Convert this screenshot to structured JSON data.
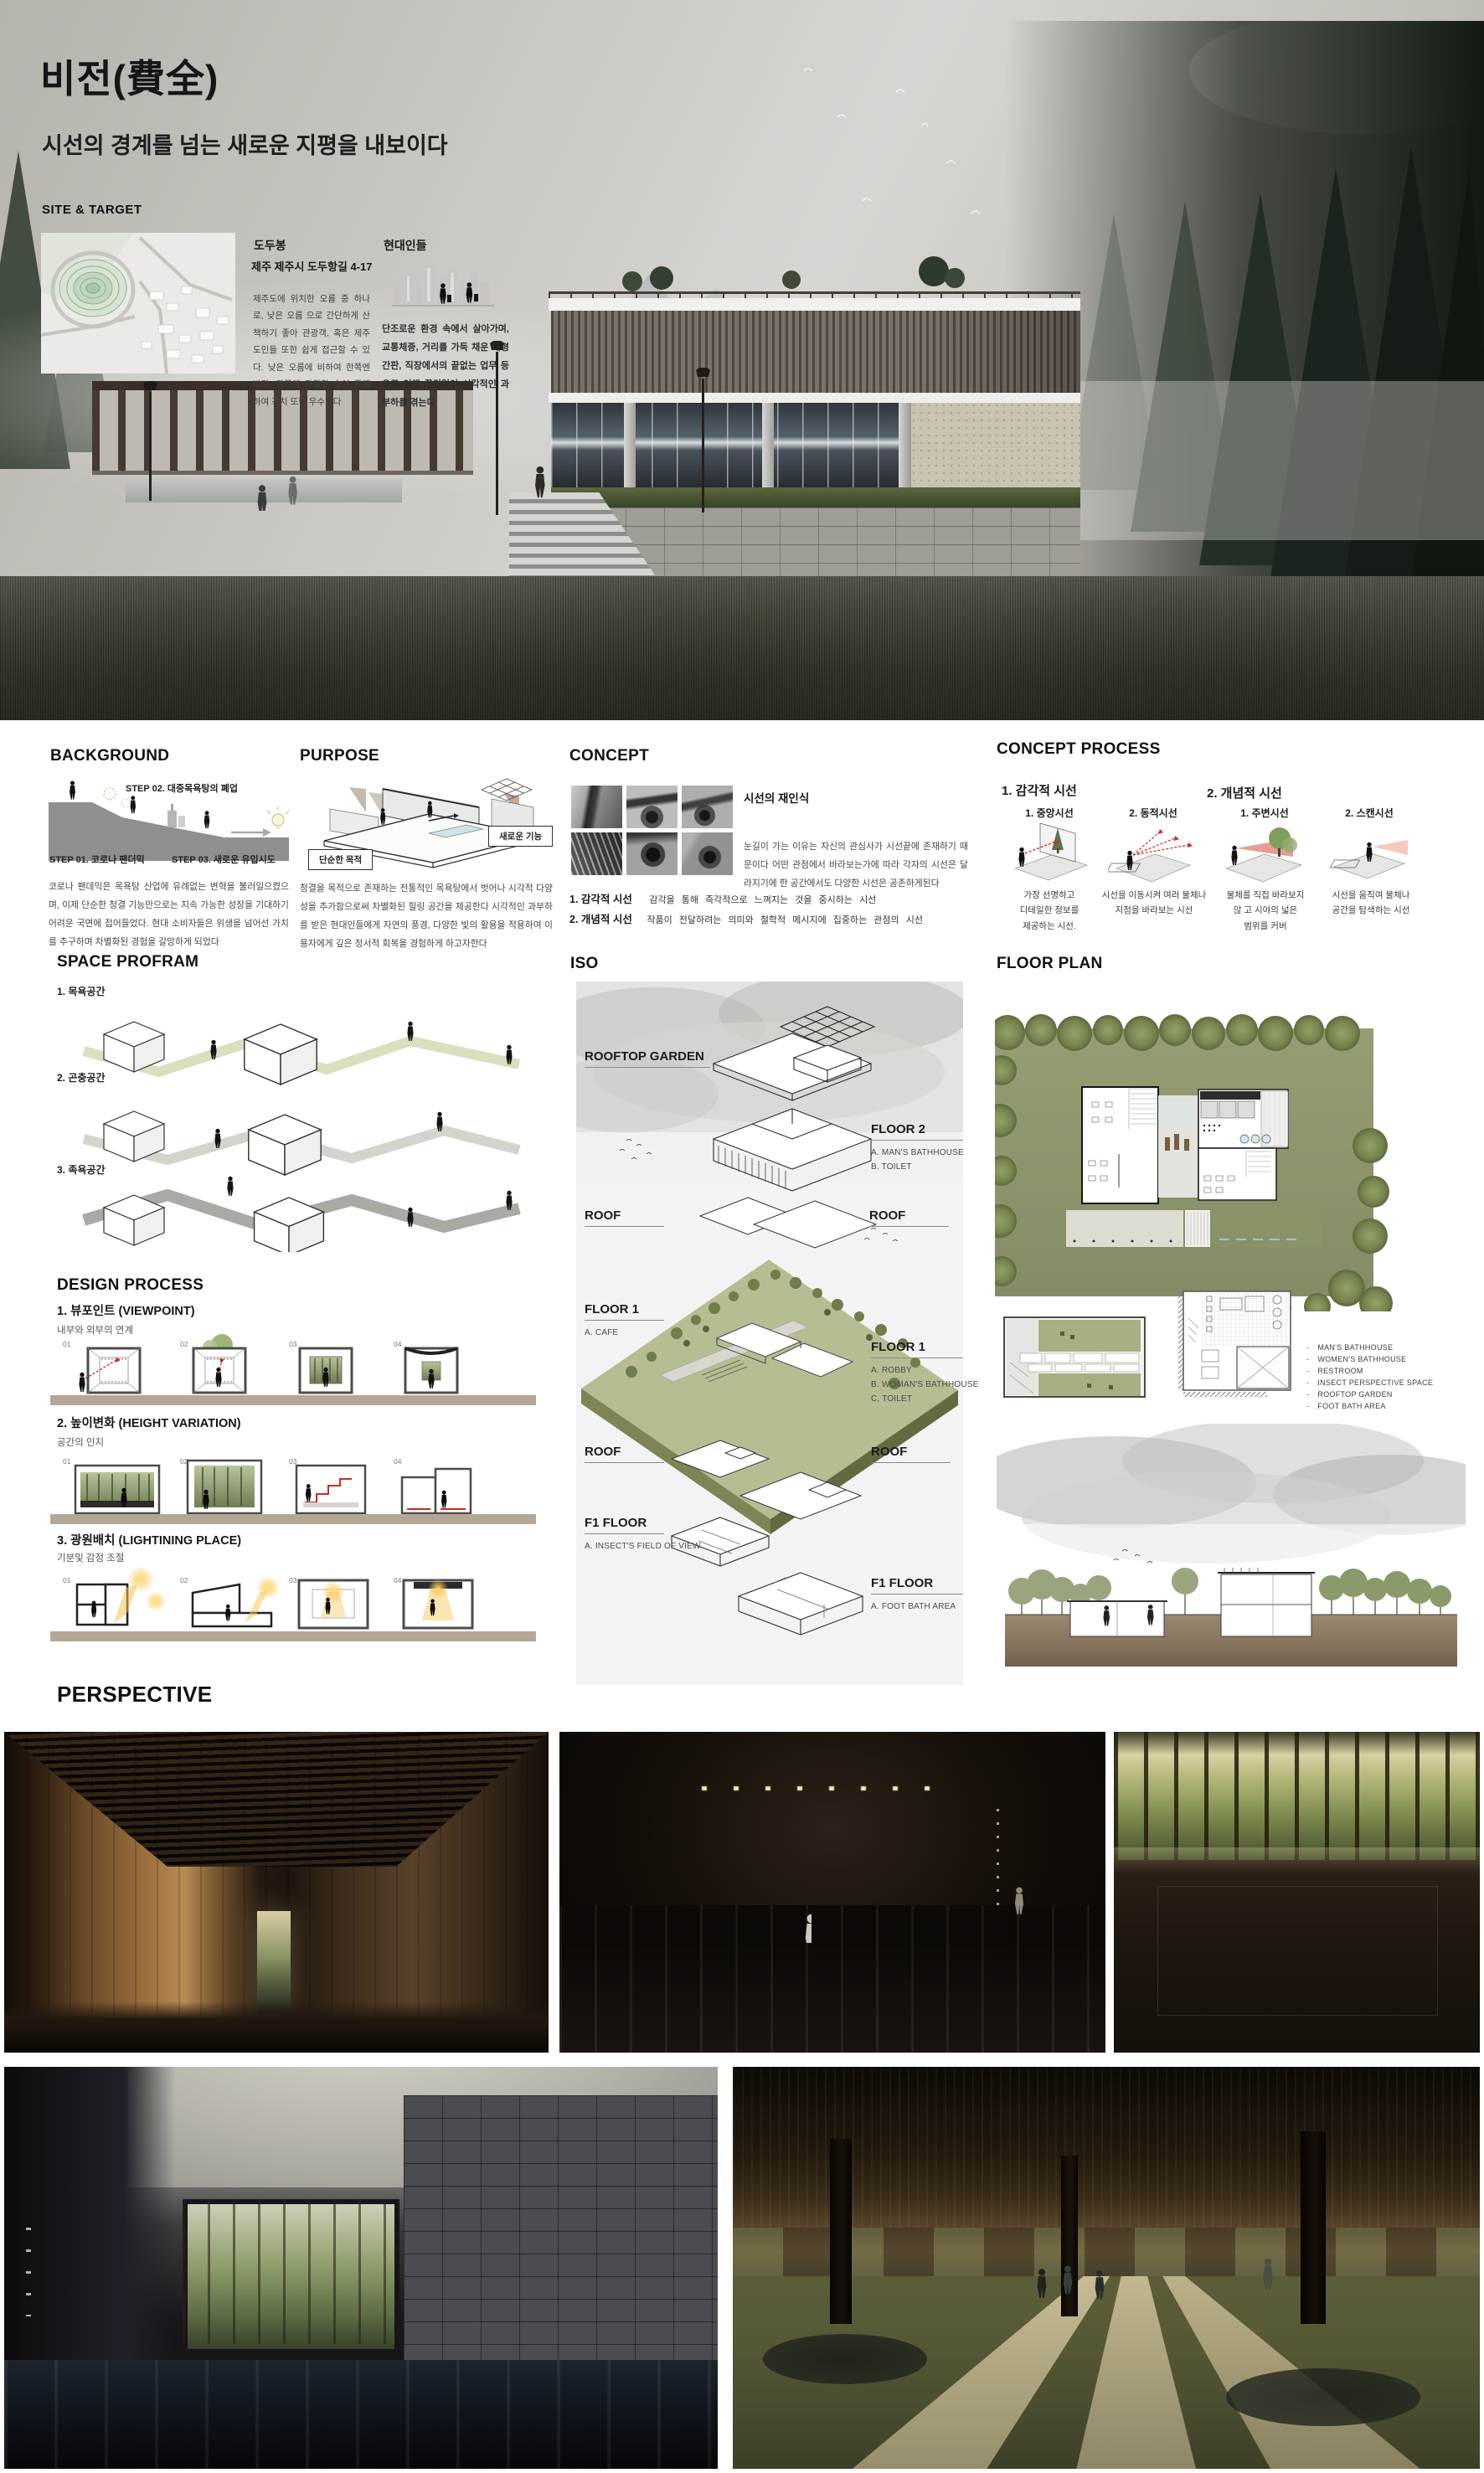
{
  "colors": {
    "accent_olive": "#aab37e",
    "process_ground": "#b5a796",
    "lawn_green": "#8f976e",
    "glow_yellow": "#f6c84c"
  },
  "hero": {
    "title": "비전(費全)",
    "subtitle": "시선의 경계를 넘는 새로운 지평을 내보이다",
    "site_target": {
      "heading": "SITE & TARGET",
      "site_name": "도두봉",
      "site_address": "제주 제주시 도두항길 4-17",
      "site_desc": "제주도에 위치한 오름 중 하나로, 낮은 오름 으로 간단하게 산책하기 좋아 관광객, 혹은 제주도민들 또한 쉽게 접근할 수 있다. 낮은 오름에 비하여 한쪽엔 바다, 한쪽엔 광활한 숲이 존재하여 경치 또한 우수하다",
      "target_name": "현대인들",
      "target_desc": "단조로운 환경 속에서 살아가며, 교통체증, 거리를 가득 채운 대형간판, 직장에서의 끝없는 업무 등으로 인해 끊임없이 시각적인 과부하를 겪는다"
    }
  },
  "background": {
    "heading": "BACKGROUND",
    "step01": "STEP 01. 코로나 팬더믹",
    "step02": "STEP 02. 대중목욕탕의 폐업",
    "step03": "STEP 03.  새로운 유입시도",
    "body": "코로나 팬데믹은 목욕탕 산업에 유례없는 변혁을 불러일으켰으며, 이제 단순한 청결 기능만으로는 지속 가능한 성장을 기대하기 어려운 국면에 접어들었다. 현대 소비자들은 위생을 넘어선 가치를 추구하며 차별화된 경험을 갈망하게 되었다"
  },
  "purpose": {
    "heading": "PURPOSE",
    "label_old": "단순한 목적",
    "label_new": "새로운 기능",
    "body": "청결을 목적으로 존재하는 전통적인 목욕탕에서 벗어나 시각적 다양성을 추가함으로써 차별화된 힐링 공간을 제공한다 시각적인 과부하를 받은 현대인들에게 자연의 풍경, 다양한 빛의 활용을 적용하여 이용자에게 깊은 정서적 회복을 경험하게 하고자한다"
  },
  "concept": {
    "heading": "CONCEPT",
    "sub": "시선의 재인식",
    "body": "눈길이 가는 이유는 자신의 관심사가 시선끝에 존재하기 때문이다 어떤 관점에서 바라보는가에 따라 각자의 시선은 달라지기에 한 공간에서도 다양한 시선은 공존하게된다",
    "item1_label": "1. 감각적 시선",
    "item1_desc": "감각을 통해 즉각적으로 느껴지는 것을 중시하는 시선",
    "item2_label": "2. 개념적 시선",
    "item2_desc": "작품이 전달하려는 의미와 철학적 메시지에 집중하는 관점의 시선"
  },
  "concept_process": {
    "heading": "CONCEPT PROCESS",
    "groups": [
      {
        "label": "1. 감각적 시선",
        "items": [
          {
            "title": "1. 중앙시선",
            "desc": "가장 선명하고\n디테일한  정보를\n제공하는 시선."
          },
          {
            "title": "2. 동적시선",
            "desc": "시선을 이동시켜 여러 물체나\n지점을 바라보는 시선"
          }
        ]
      },
      {
        "label": "2. 개념적 시선",
        "items": [
          {
            "title": "1. 주변시선",
            "desc": "물체를 직접 바라보지\n않 고 시야의 넓은\n범위를 커버"
          },
          {
            "title": "2. 스캔시선",
            "desc": "시선을 움직여 물체나\n공간을 탐색하는 시선"
          }
        ]
      }
    ]
  },
  "space": {
    "heading": "SPACE PROFRAM",
    "items": [
      "1. 목욕공간",
      "2. 곤충공간",
      "3. 족욕공간"
    ]
  },
  "design": {
    "heading": "DESIGN PROCESS",
    "nums": [
      "01",
      "02",
      "03",
      "04"
    ],
    "sections": [
      {
        "title": "1.  뷰포인트 (VIEWPOINT)",
        "subtitle": "내부와 외부의 연계"
      },
      {
        "title": "2. 높이변화 (HEIGHT VARIATION)",
        "subtitle": "공간의 인지"
      },
      {
        "title": "3. 광원배치 (LIGHTINING PLACE)",
        "subtitle": "기분및  감정 조절"
      }
    ]
  },
  "iso": {
    "heading": "ISO",
    "rooftop_garden": "ROOFTOP GARDEN",
    "floor2": "FLOOR 2",
    "floor2_lines": [
      "A. MAN'S BATHHOUSE",
      "B. TOILET"
    ],
    "roof": "ROOF",
    "floor1": "FLOOR 1",
    "floor1_left_lines": [
      "A. CAFE"
    ],
    "floor1_right_lines": [
      "A. ROBBY",
      "B. WOMAN'S BATHHOUSE",
      "C, TOILET"
    ],
    "f1": "F1 FLOOR",
    "f1_left_lines": [
      "A. INSECT'S FIELD OF VIEW"
    ],
    "f1_right_lines": [
      "A. FOOT BATH AREA"
    ]
  },
  "floor_plan": {
    "heading": "FLOOR PLAN",
    "legend": [
      "MAN'S BATHHOUSE",
      "WOMEN'S BATHHOUSE",
      "RESTROOM",
      "INSECT PERSPECTIVE SPACE",
      "ROOFTOP GARDEN",
      "FOOT BATH AREA"
    ]
  },
  "perspective": {
    "heading": "PERSPECTIVE"
  }
}
